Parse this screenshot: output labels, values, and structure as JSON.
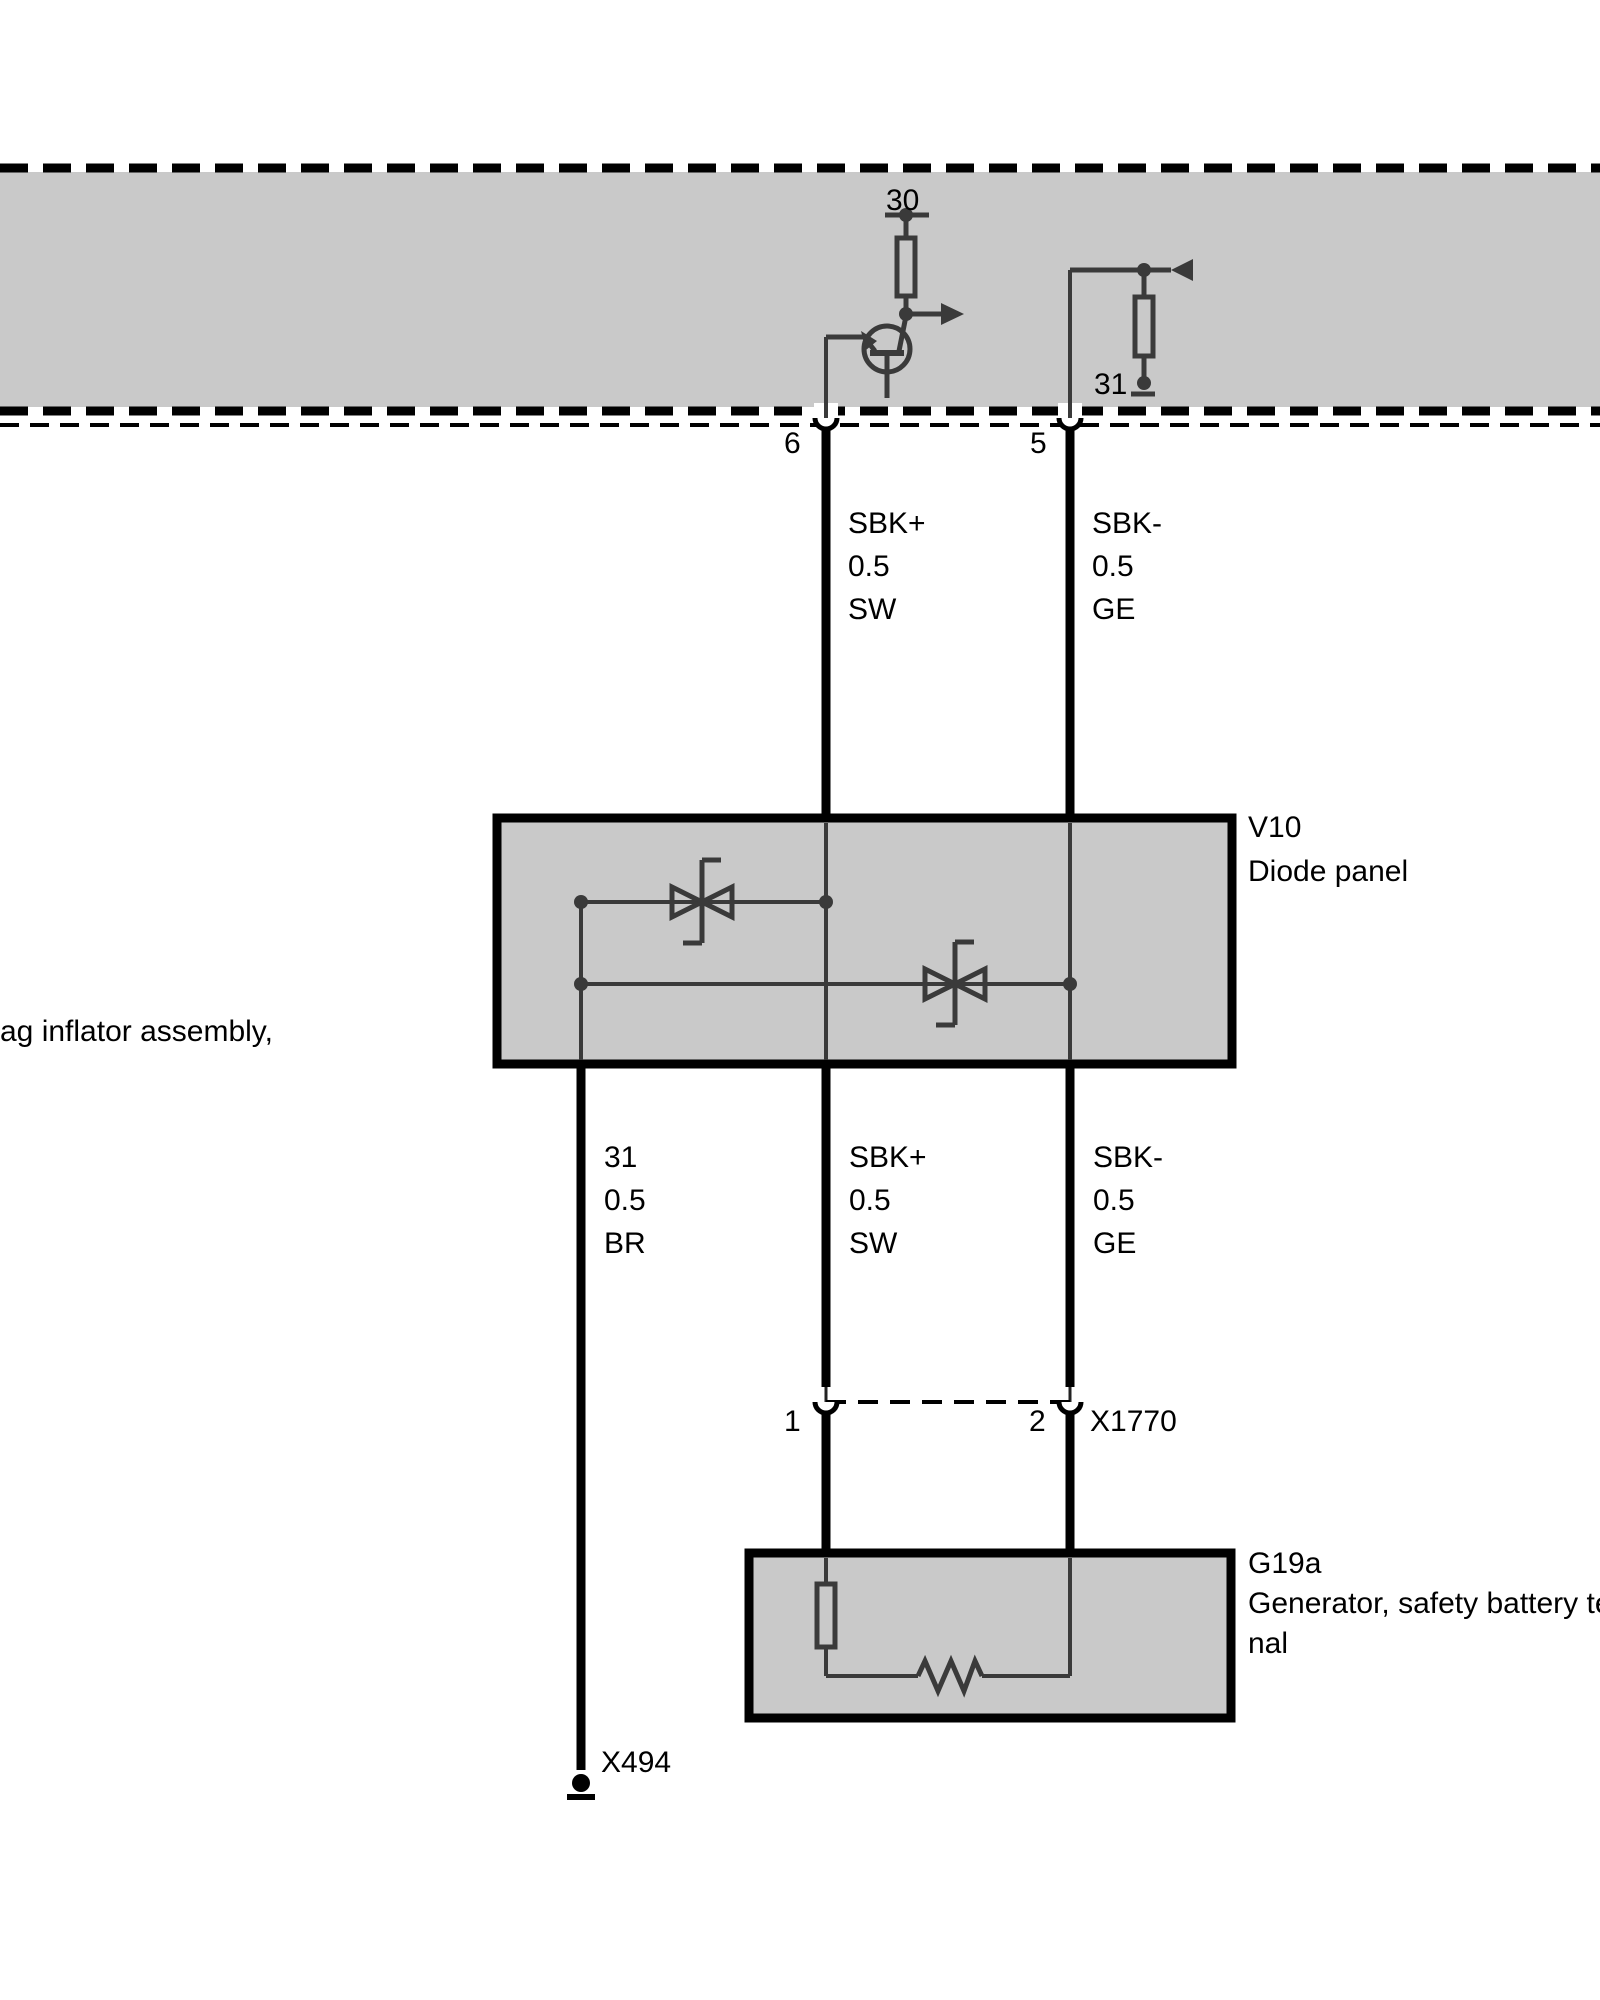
{
  "band": {
    "terminal_30": "30",
    "terminal_31": "31",
    "pin_6": "6",
    "pin_5": "5"
  },
  "upper_wires": {
    "sbk_plus": [
      "SBK+",
      "0.5",
      "SW"
    ],
    "sbk_minus": [
      "SBK-",
      "0.5",
      "GE"
    ]
  },
  "lower_wires": {
    "ground": [
      "31",
      "0.5",
      "BR"
    ],
    "sbk_plus": [
      "SBK+",
      "0.5",
      "SW"
    ],
    "sbk_minus": [
      "SBK-",
      "0.5",
      "GE"
    ]
  },
  "v10": {
    "code": "V10",
    "label": "Diode panel"
  },
  "g19a": {
    "code": "G19a",
    "label_line1": "Generator, safety battery termi",
    "label_line2": "nal"
  },
  "x1770": {
    "code": "X1770",
    "pin_1": "1",
    "pin_2": "2"
  },
  "x494": {
    "code": "X494"
  },
  "left_note": "ag inflator assembly,",
  "colors": {
    "band_fill": "#c9c9c9",
    "box_fill": "#c9c9c9",
    "circuit_line": "#3a3a3a",
    "wire": "#000000",
    "text": "#000000"
  }
}
